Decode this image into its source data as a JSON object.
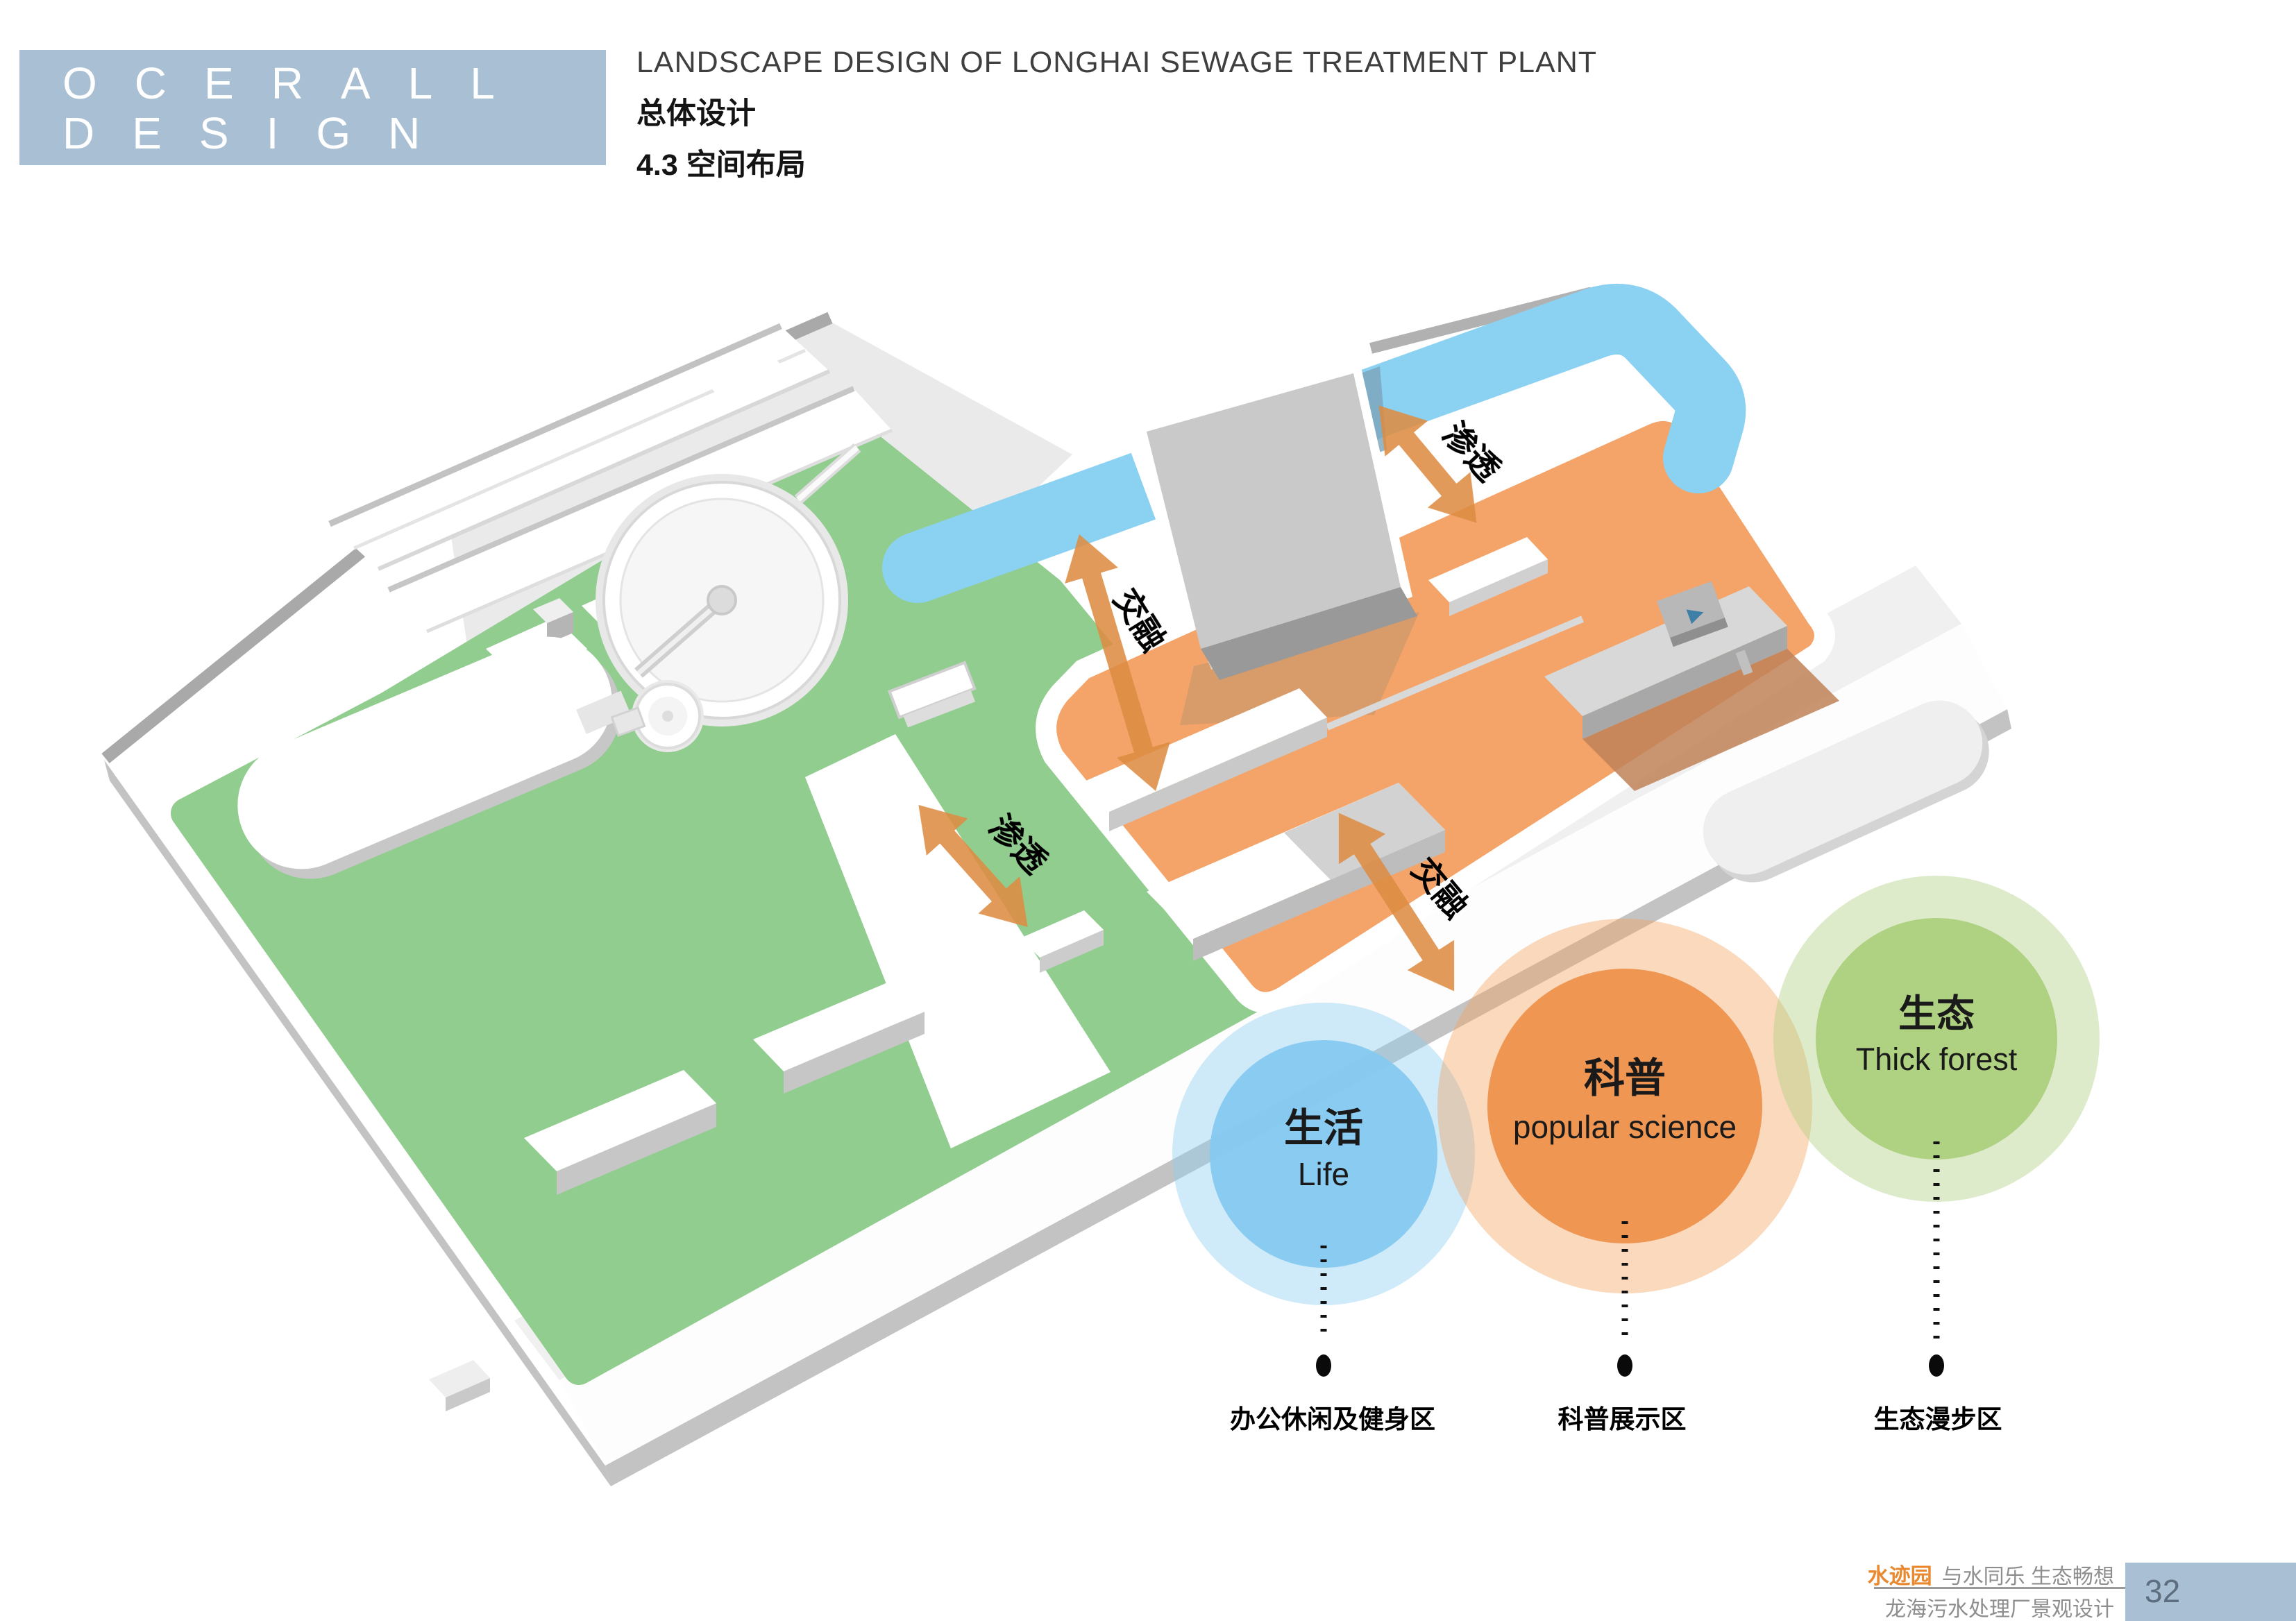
{
  "header": {
    "logo_line1": "OCERALL",
    "logo_line2": "DESIGN",
    "title_en": "LANDSCAPE DESIGN OF LONGHAI SEWAGE TREATMENT PLANT",
    "title_cn": "总体设计",
    "section": "4.3 空间布局"
  },
  "plan": {
    "zone_colors": {
      "green": "#92cd90",
      "orange": "#f4a469",
      "water": "#8ad1f2",
      "arrow": "#dd8c42"
    },
    "arrows": [
      {
        "id": "permeate-top",
        "label": "渗透"
      },
      {
        "id": "blend-left",
        "label": "交融"
      },
      {
        "id": "blend-middle",
        "label": "交融"
      },
      {
        "id": "permeate-bottom",
        "label": "渗透"
      }
    ]
  },
  "venn": {
    "zones": [
      {
        "cn": "生活",
        "en": "Life",
        "area_label": "办公休闲及健身区",
        "inner_color": "rgba(134,202,240,0.95)",
        "outer_color": "rgba(140,205,240,0.42)"
      },
      {
        "cn": "科普",
        "en": "popular science",
        "area_label": "科普展示区",
        "inner_color": "rgba(238,146,77,0.95)",
        "outer_color": "rgba(242,160,90,0.40)"
      },
      {
        "cn": "生态",
        "en": "Thick forest",
        "area_label": "生态漫步区",
        "inner_color": "rgba(172,208,125,0.95)",
        "outer_color": "rgba(176,208,130,0.42)"
      }
    ]
  },
  "footer": {
    "brand": "水迹园",
    "slogan": "与水同乐 生态畅想",
    "project": "龙海污水处理厂景观设计",
    "page": "32"
  }
}
